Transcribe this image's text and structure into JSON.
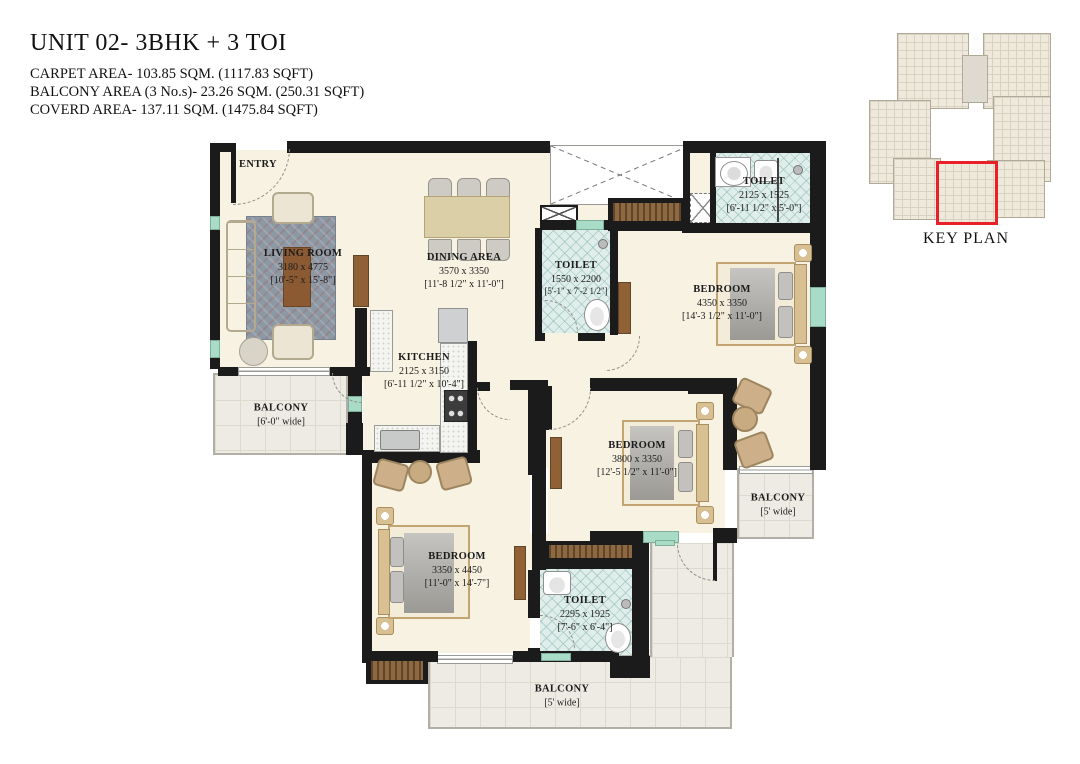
{
  "header": {
    "title": "UNIT 02- 3BHK + 3 TOI",
    "area_lines": [
      "CARPET AREA- 103.85 SQM. (1117.83 SQFT)",
      "BALCONY AREA (3 No.s)- 23.26 SQM. (250.31 SQFT)",
      "COVERD AREA- 137.11 SQM. (1475.84 SQFT)"
    ]
  },
  "key_plan": {
    "label": "KEY PLAN",
    "highlight_color": "#e8202a"
  },
  "rooms": {
    "entry": {
      "name": "ENTRY"
    },
    "living": {
      "name": "LIVING ROOM",
      "dim_mm": "3180 x 4775",
      "dim_ft": "[10'-5\" x 15'-8\"]"
    },
    "dining": {
      "name": "DINING AREA",
      "dim_mm": "3570 x 3350",
      "dim_ft": "[11'-8 1/2\" x 11'-0\"]"
    },
    "kitchen": {
      "name": "KITCHEN",
      "dim_mm": "2125 x 3150",
      "dim_ft": "[6'-11 1/2\" x 10'-4\"]"
    },
    "toilet1": {
      "name": "TOILET",
      "dim_mm": "1550 x 2200",
      "dim_ft": "[5'-1\" x 7'-2 1/2\"]"
    },
    "toilet2": {
      "name": "TOILET",
      "dim_mm": "2125 x 1525",
      "dim_ft": "[6'-11 1/2\" x 5'-0\"]"
    },
    "toilet3": {
      "name": "TOILET",
      "dim_mm": "2295 x 1925",
      "dim_ft": "[7'-6\" x 6'-4\"]"
    },
    "bedroom1": {
      "name": "BEDROOM",
      "dim_mm": "4350 x 3350",
      "dim_ft": "[14'-3 1/2\" x 11'-0\"]"
    },
    "bedroom2": {
      "name": "BEDROOM",
      "dim_mm": "3800 x 3350",
      "dim_ft": "[12'-5 1/2\" x 11'-0\"]"
    },
    "bedroom3": {
      "name": "BEDROOM",
      "dim_mm": "3350 x 4450",
      "dim_ft": "[11'-0\" x 14'-7\"]"
    },
    "balcony_left": {
      "name": "BALCONY",
      "dim_ft": "[6'-0\" wide]"
    },
    "balcony_right": {
      "name": "BALCONY",
      "dim_ft": "[5' wide]"
    },
    "balcony_bottom": {
      "name": "BALCONY",
      "dim_ft": "[5' wide]"
    }
  }
}
